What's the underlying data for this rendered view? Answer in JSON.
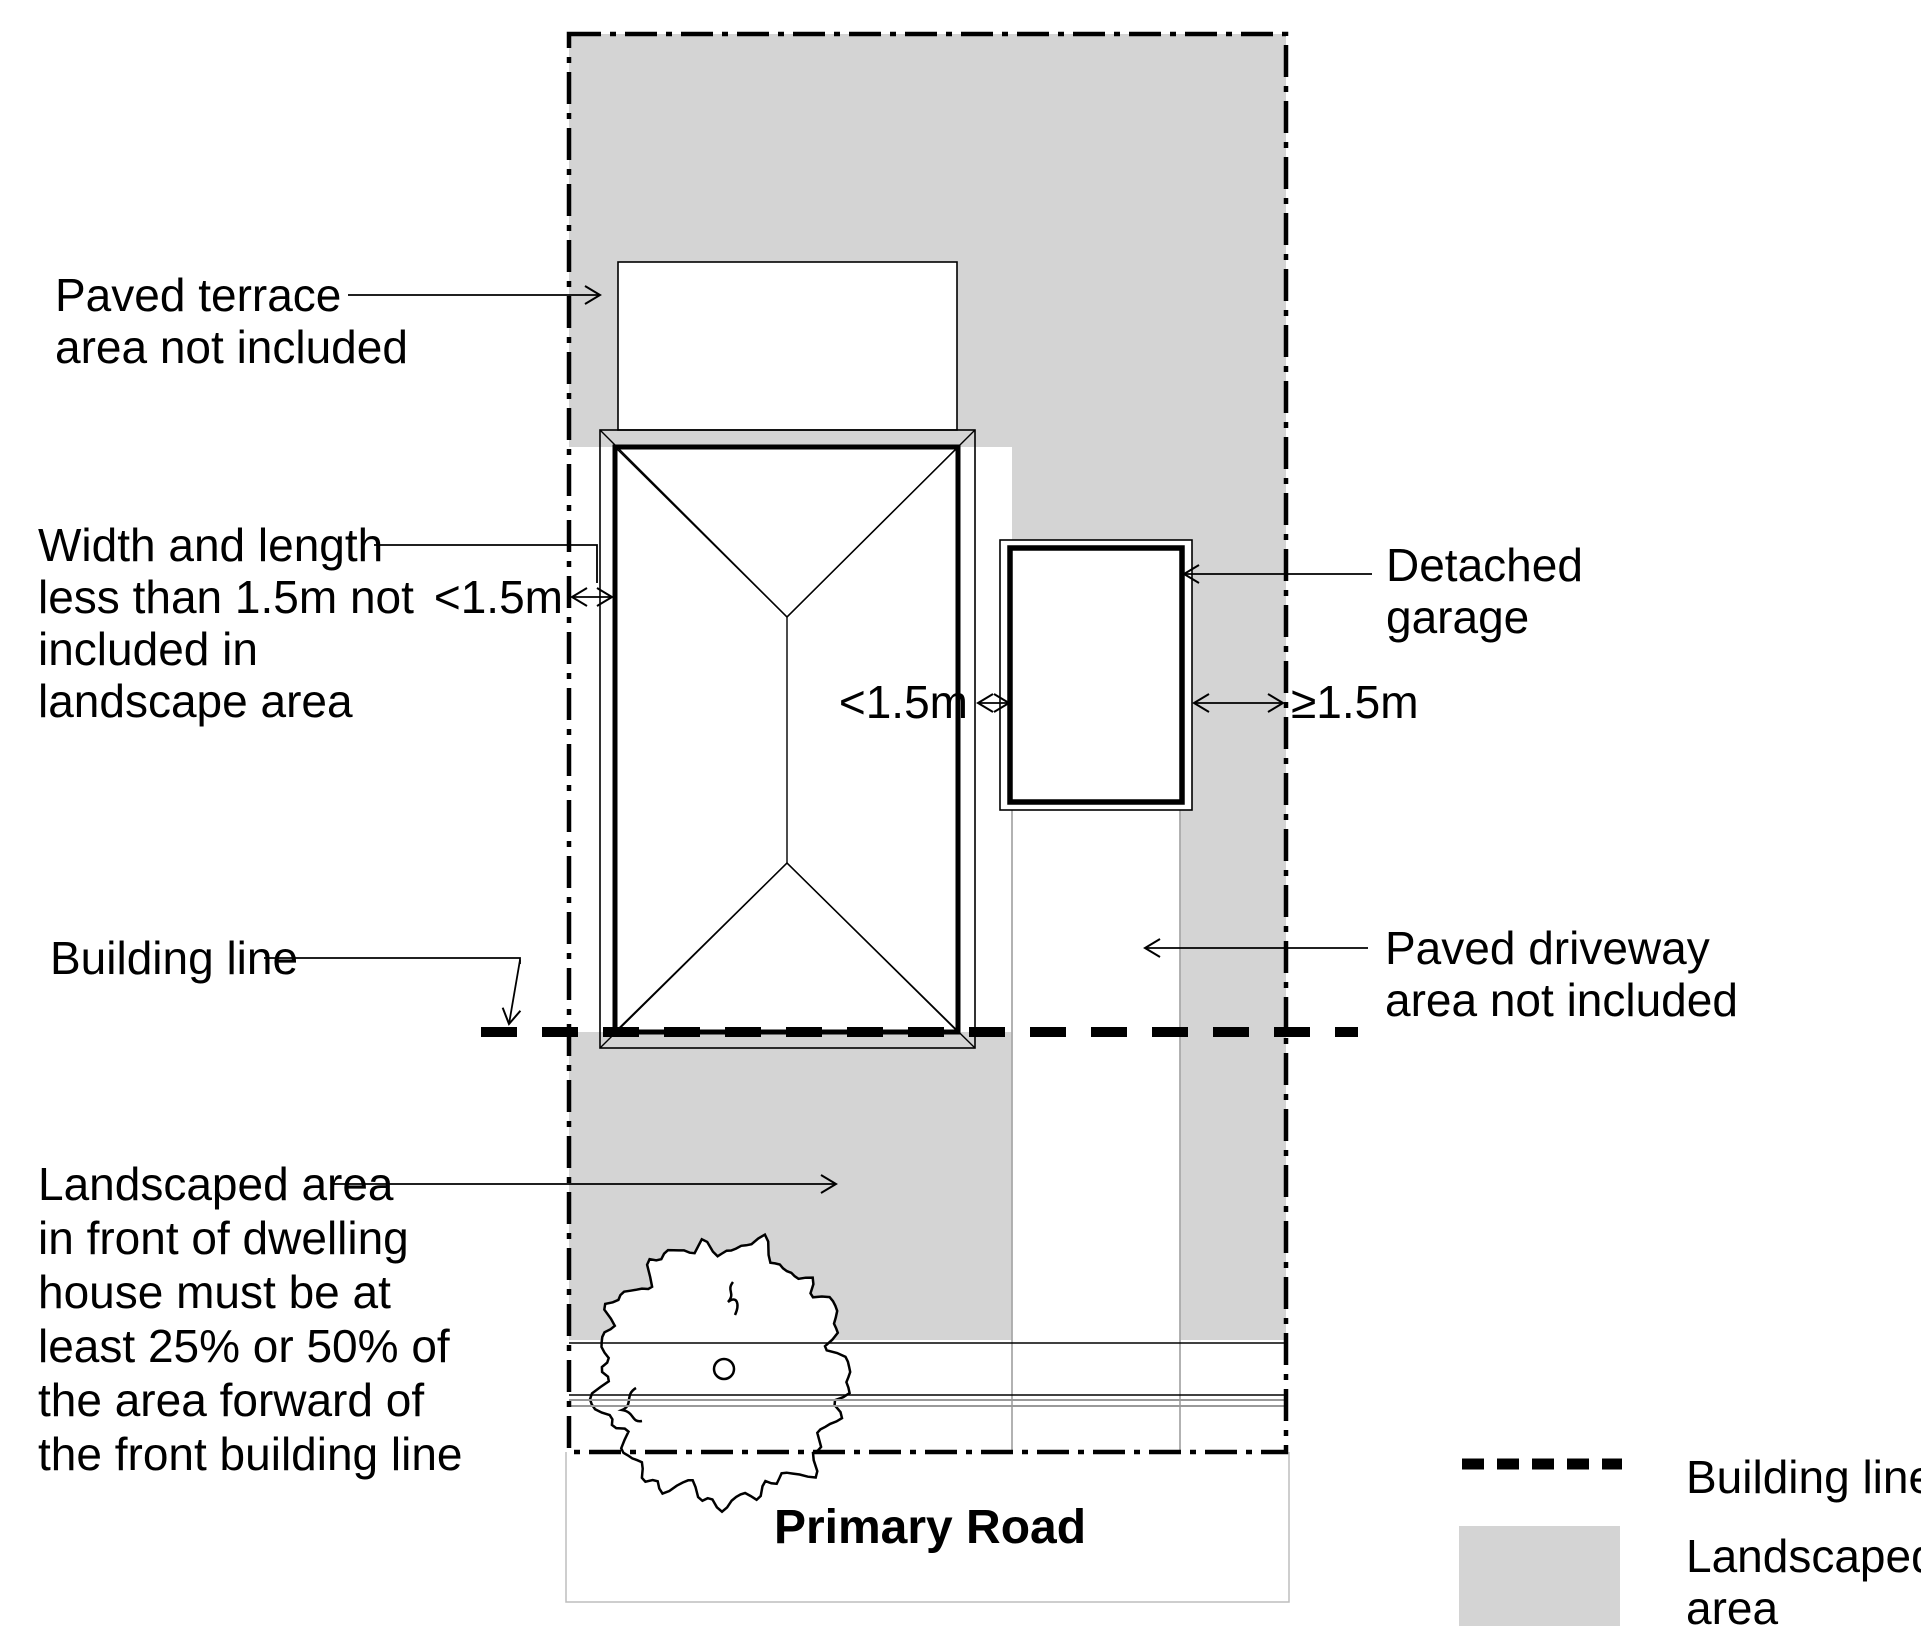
{
  "labels": {
    "paved_terrace": [
      "Paved terrace",
      "area not included"
    ],
    "width_length": [
      "Width and length",
      "less than 1.5m not",
      "included in",
      "landscape area"
    ],
    "dim_left": "<1.5m",
    "dim_mid": "<1.5m",
    "dim_right": "≥1.5m",
    "detached_garage": [
      "Detached",
      "garage"
    ],
    "building_line": "Building line",
    "paved_driveway": [
      "Paved driveway",
      "area not included"
    ],
    "landscaped_note": [
      "Landscaped area",
      "in front of dwelling",
      "house must be at",
      "least 25% or 50% of",
      "the area forward of",
      "the front building line"
    ],
    "primary_road": "Primary Road"
  },
  "legend": {
    "building_line": "Building line",
    "landscaped_area": [
      "Landscaped",
      "area"
    ]
  },
  "colors": {
    "landscaped_gray": "#d4d4d4",
    "road_line_gray": "#999999",
    "driveway_edge_gray": "#aaaaaa",
    "faint_gray": "#bdbdbd",
    "line_black": "#000000"
  }
}
